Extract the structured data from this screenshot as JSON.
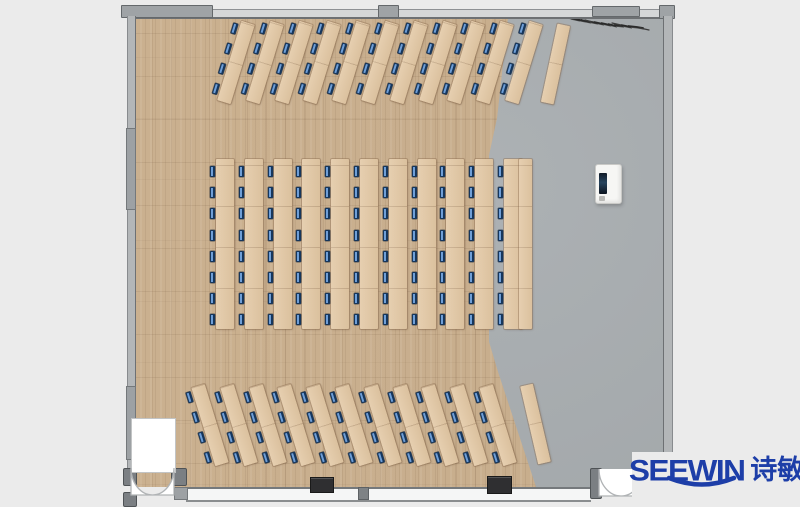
{
  "brand": {
    "name": "SEEWIN",
    "cjk_name": "诗敏",
    "logo_color": "#1d3ea8"
  },
  "palette": {
    "exterior": "#ebebeb",
    "wood_floor": "#c9ae8d",
    "desk": "#e2c7a3",
    "gray_floor": "#a8adb0",
    "wall_light": "#b3b6b8",
    "wall_dark": "#6d7073",
    "post": "#7b7f83",
    "chair_dark": "#16365c",
    "chair_light": "#6f9fd8",
    "column_box": "#2f2f31",
    "door_white": "#ffffff",
    "scribble": "#2b2b2b"
  },
  "room": {
    "x": 127,
    "y": 8,
    "width": 544,
    "height": 489
  },
  "floor": {
    "gray_rect": {
      "x": 134,
      "y": 17,
      "w": 529,
      "h": 470
    },
    "wood_polygon": [
      [
        134,
        17
      ],
      [
        508,
        17
      ],
      [
        497,
        118
      ],
      [
        489,
        155
      ],
      [
        489,
        342
      ],
      [
        498,
        372
      ],
      [
        536,
        487
      ],
      [
        134,
        487
      ]
    ]
  },
  "desk_sections": [
    {
      "id": "back-rows",
      "count": 11,
      "left0": 229,
      "spacing": 28.8,
      "top": 21,
      "w": 14,
      "h": 83,
      "angle": 17,
      "chairs": 4,
      "chair_top": 4,
      "chair_gap": 21,
      "chair_left": -7
    },
    {
      "id": "center-rows",
      "count": 11,
      "left0": 216,
      "spacing": 28.8,
      "top": 159,
      "w": 18,
      "h": 170,
      "angle": 0,
      "chairs": 8,
      "chair_top": 7,
      "chair_gap": 21.2,
      "chair_left": -6
    },
    {
      "id": "front-rows",
      "count": 11,
      "left0": 203,
      "spacing": 28.8,
      "top": 384,
      "w": 14,
      "h": 82,
      "angle": -17,
      "chairs": 4,
      "chair_top": 3,
      "chair_gap": 21,
      "chair_left": -7
    }
  ],
  "front_tables": [
    {
      "x": 549,
      "y": 24,
      "w": 13,
      "h": 80,
      "angle": 12
    },
    {
      "x": 519,
      "y": 159,
      "w": 13,
      "h": 170,
      "angle": 0
    },
    {
      "x": 529,
      "y": 384,
      "w": 13,
      "h": 80,
      "angle": -13
    }
  ],
  "walls": {
    "top_band": {
      "x": 127,
      "y": 9,
      "w": 544,
      "h": 7
    },
    "top_segments": [
      {
        "x": 121,
        "y": 5,
        "w": 90,
        "h": 11
      },
      {
        "x": 378,
        "y": 5,
        "w": 19,
        "h": 11
      },
      {
        "x": 592,
        "y": 6,
        "w": 46,
        "h": 9
      },
      {
        "x": 659,
        "y": 5,
        "w": 14,
        "h": 12
      }
    ],
    "left_band": {
      "x": 127,
      "y": 16,
      "w": 7,
      "h": 453
    },
    "left_segments": [
      {
        "x": 126,
        "y": 128,
        "w": 8,
        "h": 80
      },
      {
        "x": 126,
        "y": 386,
        "w": 8,
        "h": 72
      }
    ],
    "right_band": {
      "x": 663,
      "y": 16,
      "w": 8,
      "h": 446
    },
    "bottom_window": {
      "x": 186,
      "y": 487,
      "w": 405,
      "h": 11
    },
    "bottom_left_piece": {
      "x": 174,
      "y": 487,
      "w": 12,
      "h": 11
    },
    "mullions": [
      {
        "x": 358,
        "y": 487,
        "w": 9,
        "h": 11
      }
    ],
    "posts": [
      {
        "x": 123,
        "y": 468,
        "w": 12,
        "h": 16
      },
      {
        "x": 171,
        "y": 468,
        "w": 14,
        "h": 16
      },
      {
        "x": 590,
        "y": 468,
        "w": 10,
        "h": 29
      },
      {
        "x": 123,
        "y": 492,
        "w": 12,
        "h": 13
      }
    ]
  },
  "objects": {
    "podium": {
      "x": 595,
      "y": 164,
      "w": 25,
      "h": 38
    },
    "columns": [
      {
        "x": 310,
        "y": 477,
        "w": 22,
        "h": 14
      },
      {
        "x": 487,
        "y": 476,
        "w": 23,
        "h": 16
      }
    ],
    "scribble_path": "M565 16 l6 2 l-4 -1 l8 2 l-5 -1 l9 2 l-4 -1 l10 2 l-4 -1 l9 2 l-3 -1 l10 2 l-3 -1 l9 2 l-2 -1 l9 2 l-2 -1 l8 2 l-2 -1 l9 1 l-2 -1 l10 2 l-3 -1 l9 1 l6 1",
    "scribble_extra": "M612 23 l9 2 M585 20 l7 2 M640 28 l9 2"
  },
  "doors": {
    "left": {
      "alcove": {
        "x": 131,
        "y": 418,
        "w": 43,
        "h": 53
      },
      "arc_box": {
        "x": 131,
        "y": 468,
        "w": 43,
        "h": 27
      }
    },
    "right": {
      "arc_box": {
        "x": 599,
        "y": 469,
        "w": 44,
        "h": 27
      }
    }
  },
  "logo_patch": {
    "x": 632,
    "y": 452,
    "w": 168,
    "h": 55
  }
}
